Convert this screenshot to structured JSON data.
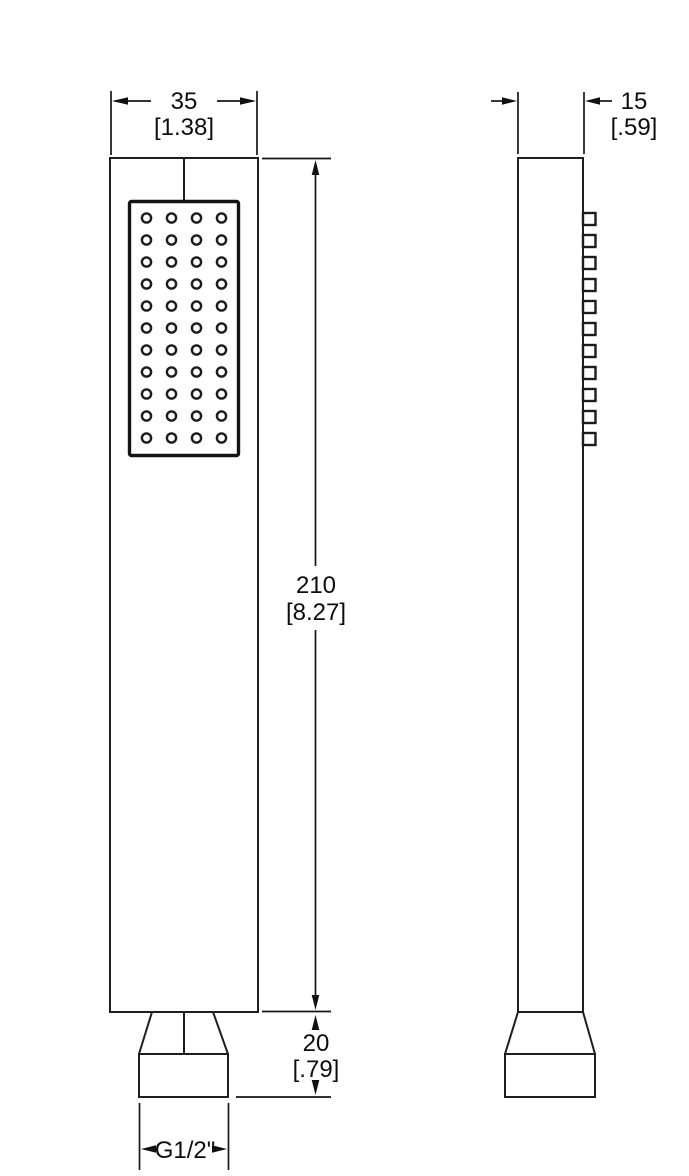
{
  "page": {
    "background": "#ffffff",
    "line_color": "#1c1c1c",
    "text_color": "#0d0d0d"
  },
  "drawing": {
    "type": "technical-dimension-drawing",
    "subject": "handheld shower wand - front and side elevation views",
    "front_view": {
      "name": "front-elevation",
      "nozzle_rows": 11,
      "nozzle_cols": 4
    },
    "side_view": {
      "name": "side-elevation",
      "nozzle_count": 11
    },
    "dimensions": {
      "width": {
        "mm": "35",
        "inch": "[1.38]"
      },
      "depth": {
        "mm": "15",
        "inch": "[.59]"
      },
      "height": {
        "mm": "210",
        "inch": "[8.27]"
      },
      "connector": {
        "mm": "20",
        "inch": "[.79]"
      },
      "thread": {
        "label": "G1/2\""
      }
    }
  }
}
